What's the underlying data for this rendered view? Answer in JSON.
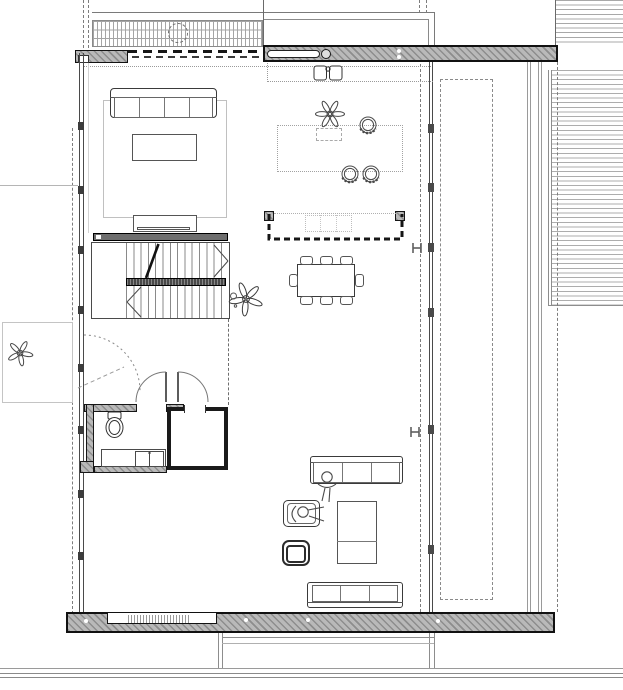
{
  "document": {
    "kind": "architectural floor plan drawing",
    "visible_text": ""
  },
  "palette": {
    "paper": "#ffffff",
    "ink": "#2f2f2f",
    "wall_fill": "#b9b9b9",
    "wall_stripe": "#8d8d8d",
    "wall_edge": "#111111",
    "stair_bar": "#5f5f5f",
    "faint_line": "#bbbbbb",
    "dash_line": "#808080"
  },
  "elements": {
    "plan": "floor plan",
    "roof_outline": "roof edge above",
    "pergola": "slatted canopy with round skylight",
    "stairs": "u-shaped staircase with mid landing",
    "void_railing": "void opening with railing posts",
    "dining": "dining table with eight chairs",
    "kitchen_counter": "kitchen counter with double sink",
    "kitchen_island": "kitchen island with bar stools and plant",
    "living_rug": "living room rug with sofa and tv console",
    "lounge": "lounge with two sofas, armchairs and tables",
    "bathroom": "wc with toilet, vanity and shower room",
    "double_doors": "double swing doors",
    "left_door": "glazed door with dashed swing",
    "deck": "timber deck boards",
    "terrace_dashed": "dashed overhang outline",
    "steel_column": "steel I-column",
    "people": "human figures",
    "plants": "potted plants"
  }
}
